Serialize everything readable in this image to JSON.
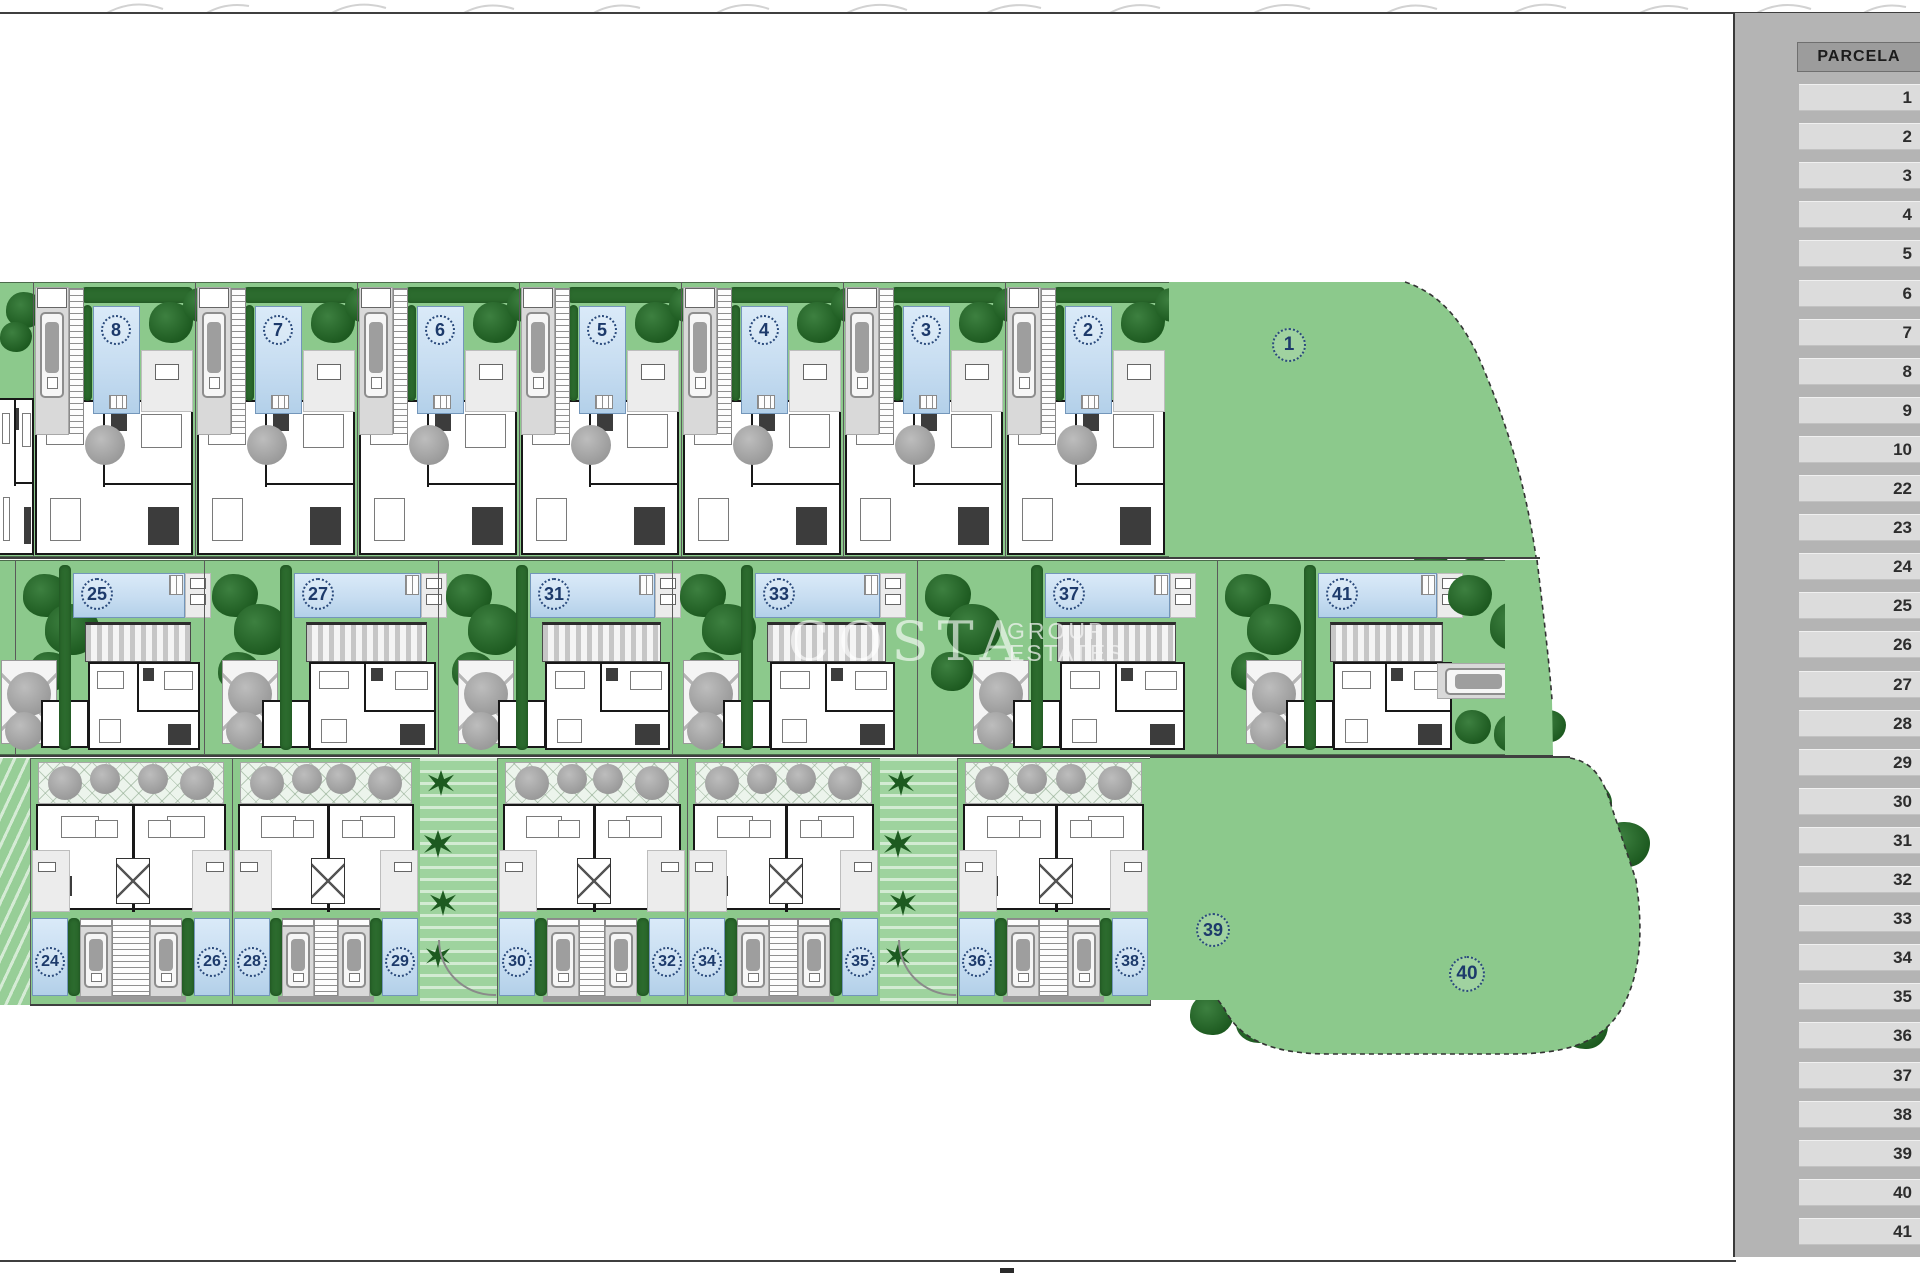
{
  "sidebar": {
    "header": "PARCELA",
    "rows": [
      "1",
      "2",
      "3",
      "4",
      "5",
      "6",
      "7",
      "8",
      "9",
      "10",
      "22",
      "23",
      "24",
      "25",
      "26",
      "27",
      "28",
      "29",
      "30",
      "31",
      "32",
      "33",
      "34",
      "35",
      "36",
      "37",
      "38",
      "39",
      "40",
      "41"
    ]
  },
  "watermark": {
    "brand": "COSTA",
    "line2": "GROUP",
    "line3": "ESTATES"
  },
  "plan": {
    "top_row": {
      "villas": [
        {
          "num": "8"
        },
        {
          "num": "7"
        },
        {
          "num": "6"
        },
        {
          "num": "5"
        },
        {
          "num": "4"
        },
        {
          "num": "3"
        },
        {
          "num": "2"
        }
      ],
      "villa1": {
        "num": "1"
      }
    },
    "middle_row": {
      "villas": [
        {
          "num": "25"
        },
        {
          "num": "27"
        },
        {
          "num": "31"
        },
        {
          "num": "33"
        },
        {
          "num": "37"
        },
        {
          "num": "41"
        }
      ]
    },
    "bottom_row": {
      "pairs": [
        {
          "left": "24",
          "right": "26"
        },
        {
          "left": "28",
          "right": "29"
        },
        {
          "left": "30",
          "right": "32"
        },
        {
          "left": "34",
          "right": "35"
        },
        {
          "left": "36",
          "right": "38"
        }
      ],
      "villa39": {
        "num": "39"
      },
      "villa40": {
        "num": "40"
      }
    }
  }
}
